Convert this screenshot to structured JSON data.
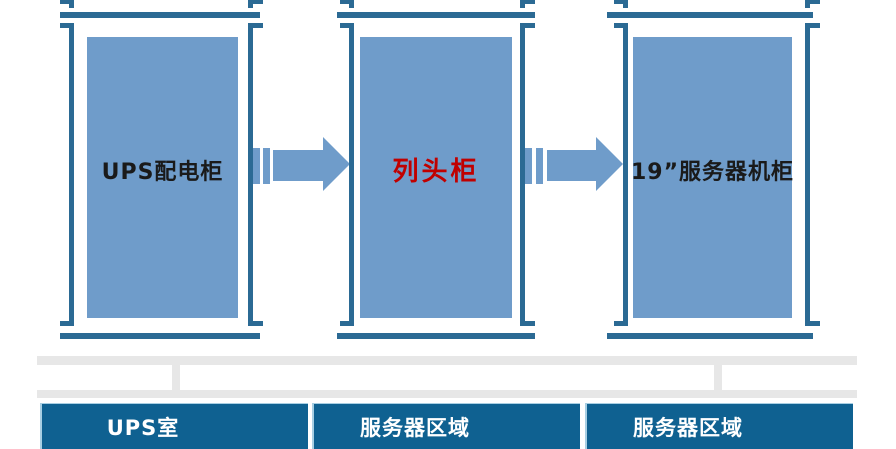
{
  "cabinets": [
    {
      "label": "UPS配电柜",
      "text_color": "#1a1a1a"
    },
    {
      "label": "列头柜",
      "text_color": "#c00000"
    },
    {
      "label": "19”服务器机柜",
      "text_color": "#1a1a1a"
    }
  ],
  "zones": [
    {
      "label": "UPS室"
    },
    {
      "label": "服务器区域"
    },
    {
      "label": "服务器区域"
    }
  ],
  "colors": {
    "cabinet_fill": "#6f9cca",
    "rail_and_bracket": "#2b6a94",
    "arrow": "#6f9cca",
    "zone_fill": "#0f6191",
    "zone_text": "#ffffff",
    "connector_gray": "#e7e7e7",
    "highlight_label": "#c00000"
  }
}
